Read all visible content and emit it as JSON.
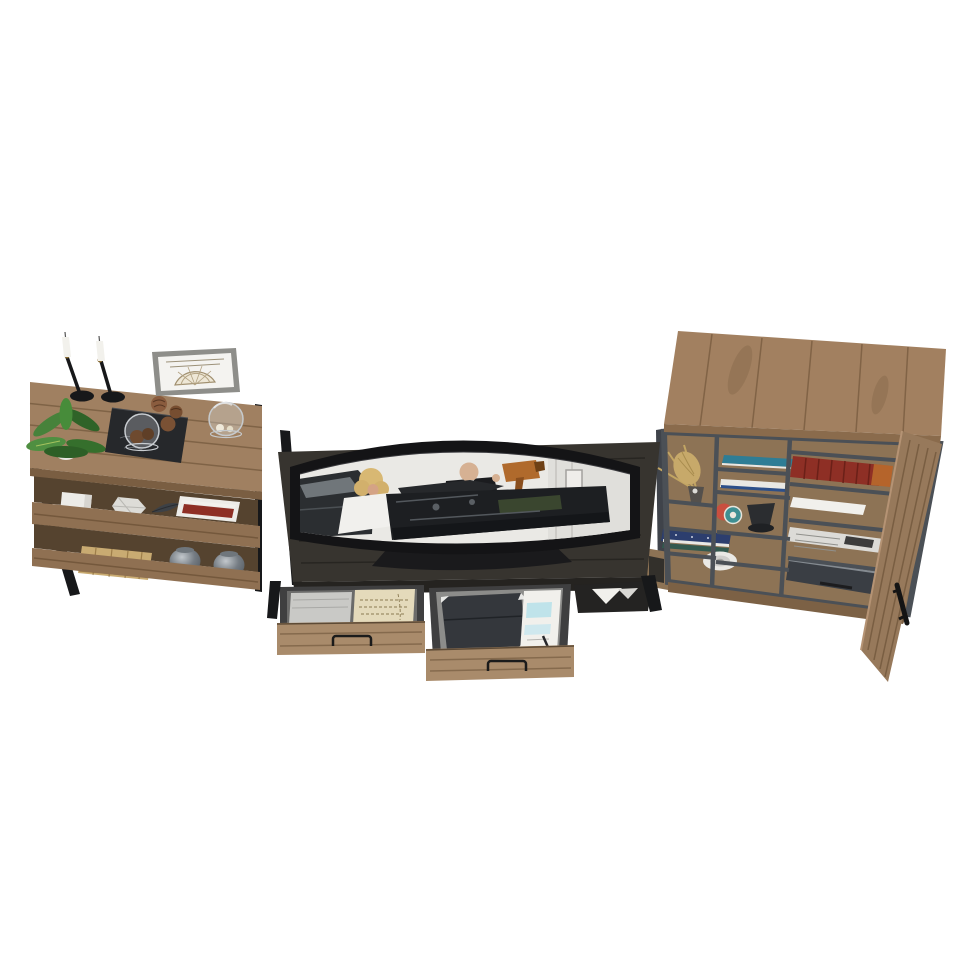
{
  "meta": {
    "title": "Three-piece rustic industrial entertainment center, high-angle product render on white background",
    "background": "#ffffff"
  },
  "palette": {
    "wood": "#a08061",
    "wood_shade": "#8f7052",
    "wood_edge": "#7a5e42",
    "shadow_wood": "#55432f",
    "charcoal": "#37342f",
    "charcoal_dark": "#252320",
    "metal": "#17181a",
    "drawer_wood": "#a98b6b",
    "cabinet_wood": "#a28060",
    "interior_wood": "#8d7355",
    "door_wood": "#97795b",
    "divider_gray": "#4b5056",
    "screen_bg": "#eae9e5",
    "paper": "#f1f0ec",
    "leaf": "#47823b",
    "red_book": "#8e2f25",
    "teal_book": "#2e7d95",
    "navy_book": "#2c3e6e",
    "basket_tan": "#c9ab72",
    "grass_tan": "#c7a96a",
    "glass": "#cdd1d3"
  },
  "pieces": {
    "left_console": {
      "label": "Open bookshelf console with black metal frame",
      "top_items": [
        {
          "name": "taper-candle-left",
          "desc": "white taper candle in round black holder"
        },
        {
          "name": "taper-candle-right",
          "desc": "white taper candle in round black holder"
        },
        {
          "name": "potted-plant",
          "desc": "green leafy plant in white pot"
        },
        {
          "name": "display-book-with-cloche",
          "desc": "black display book topped with glass dome of pinecones"
        },
        {
          "name": "pinecones",
          "desc": "loose brown pinecones"
        },
        {
          "name": "framed-print",
          "desc": "silver-framed antique fan chart"
        },
        {
          "name": "glass-cloche",
          "desc": "glass dome with small shells"
        }
      ],
      "middle_shelf_items": [
        {
          "name": "white-box",
          "desc": "small white box"
        },
        {
          "name": "faceted-ornament",
          "desc": "white geometric ornament"
        },
        {
          "name": "feather",
          "desc": "dark feather"
        },
        {
          "name": "book-stack",
          "desc": "white and rust-red books"
        }
      ],
      "bottom_shelf_items": [
        {
          "name": "woven-basket",
          "desc": "tan woven basket"
        },
        {
          "name": "mercury-jar-left",
          "desc": "textured silver glass jar"
        },
        {
          "name": "mercury-jar-right",
          "desc": "textured silver glass jar"
        }
      ]
    },
    "tv_stand": {
      "label": "Charcoal wood media desk with curved monitor",
      "monitor": {
        "label": "curved ultrawide monitor",
        "content": "movie still: blonde woman in white and bald man in dark suit working over a dark machine in a bright garage"
      },
      "cubby": {
        "label": "open side cubby with loose paper"
      },
      "drawers": [
        {
          "label": "left drawer, pulled open",
          "contents": "stack of gray paper and a handwritten letter"
        },
        {
          "label": "right drawer, pulled open",
          "contents": "dark folder and printed white papers"
        }
      ]
    },
    "right_cabinet": {
      "label": "Rustic storage hutch with open cubbies and open door",
      "shelf_items": [
        {
          "name": "dried-grass",
          "desc": "dried grass bundle in dark vase"
        },
        {
          "name": "teal-book",
          "desc": "teal hardcover laid flat"
        },
        {
          "name": "white-navy-book",
          "desc": "white book with navy stripe"
        },
        {
          "name": "tape-rolls",
          "desc": "red and teal tape rolls"
        },
        {
          "name": "black-funnel",
          "desc": "small black funnel"
        },
        {
          "name": "navy-book-stack",
          "desc": "stack of patterned navy books"
        },
        {
          "name": "ceramic-plate",
          "desc": "white ceramic plate"
        },
        {
          "name": "red-book-row",
          "desc": "row of red hardcover books"
        },
        {
          "name": "loose-papers",
          "desc": "loose white papers at back"
        },
        {
          "name": "white-sheet",
          "desc": "single white sheet"
        },
        {
          "name": "newspapers",
          "desc": "folded newspapers"
        },
        {
          "name": "dark-binder",
          "desc": "dark document case"
        }
      ],
      "door": {
        "label": "open right door with black pull handle"
      }
    }
  }
}
